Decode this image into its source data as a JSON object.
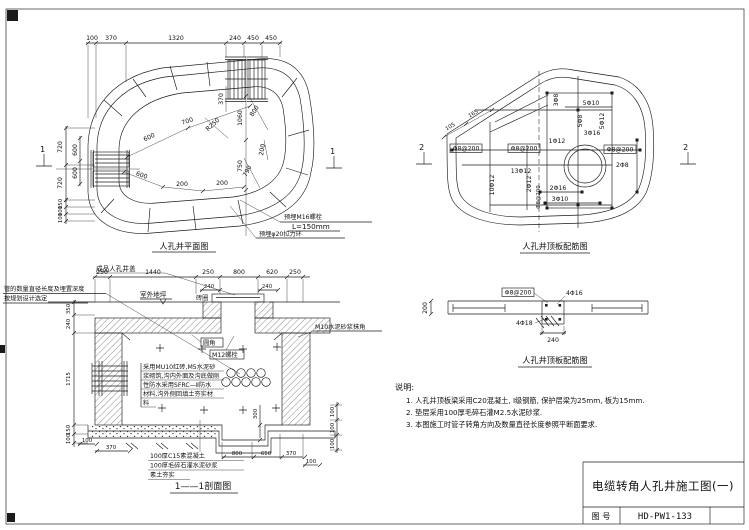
{
  "sheet": {
    "figure_title": "电缆转角人孔井施工图(一)",
    "drawing_no_label": "图  号",
    "drawing_no": "HD-PW1-133"
  },
  "plan": {
    "caption": "人孔井平面图",
    "section_marker": "1",
    "top_dims": [
      "100",
      "370",
      "1320",
      "240",
      "450",
      "450"
    ],
    "left_outer_dims": [
      "720",
      "720"
    ],
    "left_inner_dims": [
      "600",
      "600"
    ],
    "left_bottom_dims": [
      "150",
      "100",
      "100"
    ],
    "inner_dims": {
      "d370": "370",
      "d1060": "1060",
      "r250": "R250",
      "d800": "800",
      "d700": "700",
      "d600a": "600",
      "d600b": "600",
      "d200a": "200",
      "d200b": "200",
      "d750": "750",
      "d790": "790",
      "d200c": "200"
    },
    "callout_bolt": "预埋M16螺栓",
    "callout_bolt_len": "L=150mm",
    "callout_ring": "预埋φ20拉力环"
  },
  "slab": {
    "caption": "人孔井顶板配筋图",
    "section_marker": "2",
    "labels": {
      "stirrup_left": "Φ8@200",
      "stirrup_mid": "Φ8@200",
      "stirrup_right": "Φ8@200",
      "stirrup_bottom": "Φ8@200",
      "bar_1d12": "1Φ12",
      "bar_13d12": "13Φ12",
      "bar_10d12": "10Φ12",
      "bar_2d12": "2Φ12",
      "bar_2d16": "2Φ16",
      "bar_3d10": "3Φ10",
      "bar_2d8": "2Φ8",
      "bar_3d8": "3Φ8",
      "bar_5d10": "5Φ10",
      "bar_5d8": "5Φ8",
      "bar_3d16": "3Φ16",
      "bar_5d12": "5Φ12",
      "dim_105": "105",
      "dim_165": "165"
    }
  },
  "beam": {
    "caption": "人孔井顶板配筋图",
    "stirrup": "Φ8@200",
    "top_bars": "4Φ16",
    "bottom_bars": "4Φ18",
    "width_dim": "240",
    "height_dim": "200"
  },
  "section": {
    "caption": "1——1剖面图",
    "cover_label": "成品人孔井盖",
    "ground_label": "室外地坪",
    "brick_ring_label": "砖圈",
    "pipe_note_line1": "管的数量直径长度及埋置深度",
    "pipe_note_line2": "按规划设计选定",
    "fillet_label": "圆角",
    "bolt_label": "M12螺栓",
    "plaster_label": "M10水泥砂浆抹角",
    "top_dims": [
      "250",
      "1440",
      "250",
      "800",
      "620",
      "250"
    ],
    "cover_dims": [
      "240",
      "240"
    ],
    "left_dims": [
      "350",
      "240",
      "1715",
      "150",
      "100"
    ],
    "wall_note": [
      "采用MU10红砖,M5水泥砂",
      "浆砌筑,沟内外面及沟底做刚",
      "性防水采用SFRC—Ⅱ防水",
      "材料,沟外侧回填土夯实材",
      "料"
    ],
    "bottom_notes": [
      "100厚C15素混凝土",
      "100厚毛碎石灌水泥砂浆",
      "素土夯实"
    ],
    "bottom_left_dims": [
      "100",
      "370"
    ],
    "bottom_right_dims": [
      "800",
      "650",
      "370",
      "100"
    ],
    "right_dims": [
      "100",
      "100",
      "100"
    ],
    "sump_depth": "300"
  },
  "notes": {
    "heading": "说明:",
    "items": [
      "1. 人孔井顶板梁采用C20混凝土, Ⅰ级钢筋, 保护层梁为25mm, 板为15mm.",
      "2. 垫层采用100厚毛碎石灌M2.5水泥砂浆.",
      "3. 本图施工时管子转角方向及数量直径长度参照平断面要求."
    ]
  }
}
